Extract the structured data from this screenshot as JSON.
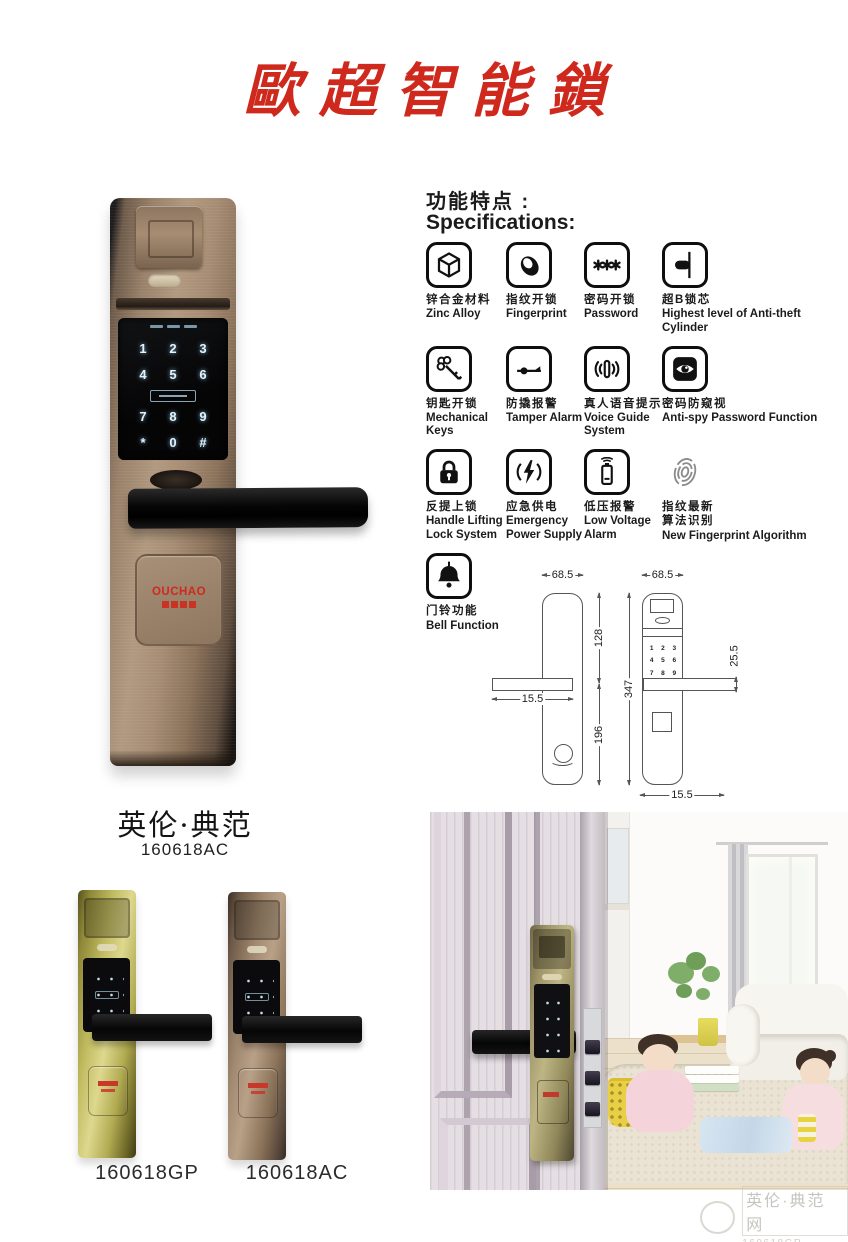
{
  "page": {
    "title": "歐超智能鎖"
  },
  "specs": {
    "heading_cn": "功能特点 :",
    "heading_en": "Specifications:",
    "items": [
      {
        "icon": "cube-icon",
        "cn": "锌合金材料",
        "en": "Zinc Alloy"
      },
      {
        "icon": "fingerprint-icon",
        "cn": "指纹开锁",
        "en": "Fingerprint"
      },
      {
        "icon": "password-icon",
        "cn": "密码开锁",
        "en": "Password"
      },
      {
        "icon": "cylinder-icon",
        "cn": "超B锁芯",
        "en": "Highest level of Anti-theft Cylinder"
      },
      {
        "icon": "key-icon",
        "cn": "钥匙开锁",
        "en": "Mechanical Keys"
      },
      {
        "icon": "tamper-alarm-icon",
        "cn": "防撬报警",
        "en": "Tamper Alarm"
      },
      {
        "icon": "voice-guide-icon",
        "cn": "真人语音提示",
        "en": "Voice Guide System"
      },
      {
        "icon": "anti-spy-eye-icon",
        "cn": "密码防窥视",
        "en": "Anti-spy Password Function"
      },
      {
        "icon": "padlock-icon",
        "cn": "反提上锁",
        "en": "Handle Lifting Lock System"
      },
      {
        "icon": "lightning-icon",
        "cn": "应急供电",
        "en": "Emergency Power Supply"
      },
      {
        "icon": "battery-icon",
        "cn": "低压报警",
        "en": "Low Voltage Alarm"
      },
      {
        "icon": "new-fingerprint-icon",
        "cn": "指纹最新\n算法识别",
        "en": "New Fingerprint Algorithm"
      },
      {
        "icon": "bell-icon",
        "cn": "门铃功能",
        "en": "Bell Function"
      }
    ]
  },
  "keypad": {
    "keys": [
      "1",
      "2",
      "3",
      "4",
      "5",
      "6",
      "7",
      "8",
      "9",
      "*",
      "0",
      "#"
    ]
  },
  "brand": {
    "logo": "OUCHAO"
  },
  "series": {
    "name": "英伦·典范",
    "model": "160618AC"
  },
  "variants": [
    {
      "model": "160618GP"
    },
    {
      "model": "160618AC"
    }
  ],
  "dims": {
    "back": {
      "width": "68.5",
      "upper": "128",
      "lower": "196",
      "handle": "15.5"
    },
    "front": {
      "width": "68.5",
      "height": "347",
      "handle": "25.5",
      "bottom": "15.5"
    }
  },
  "watermark": {
    "line1": "英伦·典范 网",
    "line2": "160618GP"
  },
  "colors": {
    "accent_red": "#cf291d",
    "bronze": "#a68c73",
    "gold": "#c3bd62"
  }
}
